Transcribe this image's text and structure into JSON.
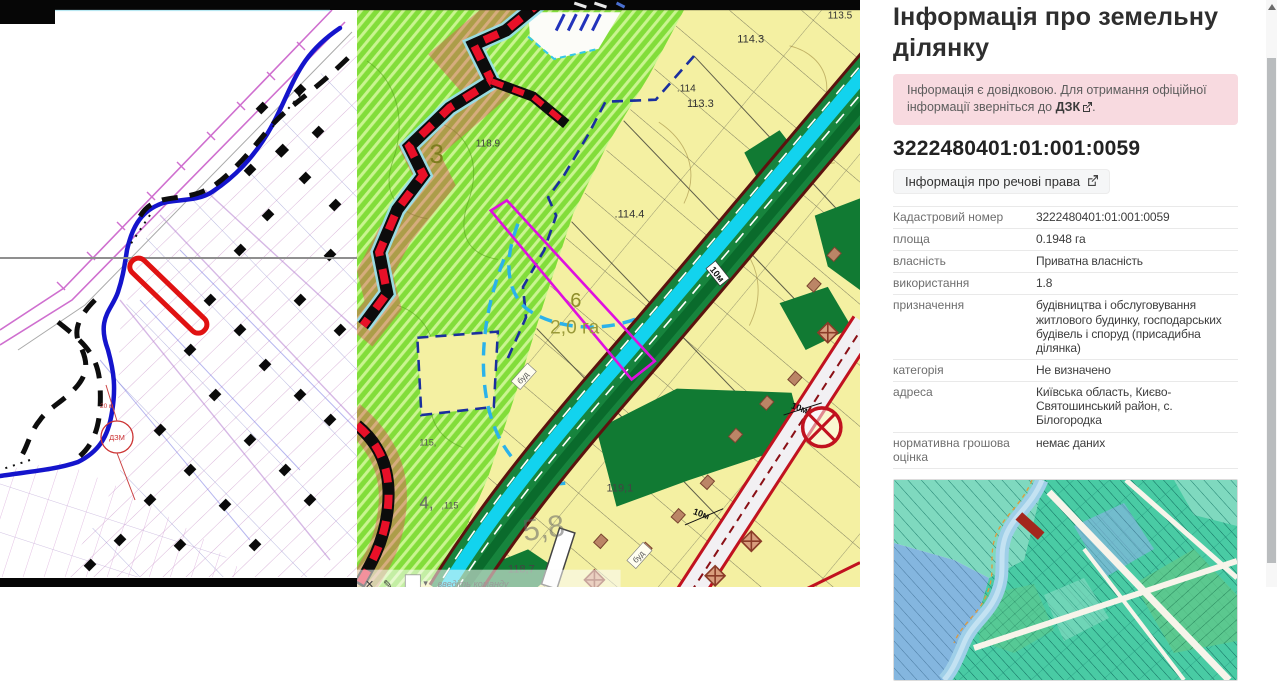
{
  "left_map": {
    "dzm_label": "ДЗМ",
    "distance_label": "20 м"
  },
  "mid_map": {
    "zone_3": "3",
    "zone_6": "6",
    "zone_4": "4,",
    "area_label": "2,0 га",
    "area_5_8": "5,8",
    "elev_113_5": "113.5",
    "elev_114_3": "114.3",
    "elev_113_3": "113.3",
    "elev_114": ".114",
    "elev_114_4": ".114.4",
    "elev_118_9": "118.9",
    "elev_119_1": "119,1",
    "elev_118_7": "118,7",
    "elev_115a": "115,",
    "elev_115b": ",115",
    "road_width_label_1": "10м",
    "road_width_label_2": "10м",
    "road_width_label_3": "10м",
    "bud_label_1": "буд",
    "bud_label_2": "буд",
    "command_bar": {
      "close_icon": "✕",
      "pencil_icon": "✎",
      "dropdown_icon": "▾",
      "hint": "введіть команду"
    }
  },
  "panel": {
    "title": "Інформація про земельну ділянку",
    "notice": {
      "text_before_link": "Інформація є довідковою. Для отримання офіційної інформації зверніться до ",
      "link_label": "ДЗК",
      "text_after_link": "."
    },
    "parcel_id": "3222480401:01:001:0059",
    "rights_button_label": "Інформація про речові права",
    "details": [
      {
        "label": "Кадастровий номер",
        "value": "3222480401:01:001:0059"
      },
      {
        "label": "площа",
        "value": "0.1948 га"
      },
      {
        "label": "власність",
        "value": "Приватна власність"
      },
      {
        "label": "використання",
        "value": "1.8"
      },
      {
        "label": "призначення",
        "value": "будівництва і обслуговування житлового будинку, господарських будівель і споруд (присадибна ділянка)"
      },
      {
        "label": "категорія",
        "value": "Не визначено"
      },
      {
        "label": "адреса",
        "value": "Київська область, Києво-Святошинський район, с. Білогородка"
      },
      {
        "label": "нормативна грошова оцінка",
        "value": "немає даних"
      }
    ]
  },
  "colors": {
    "alert_bg": "#f8dae0",
    "selected_parcel_red": "#e01212",
    "selected_parcel_magenta": "#df10df",
    "minimap_highlight": "#a3271d"
  }
}
